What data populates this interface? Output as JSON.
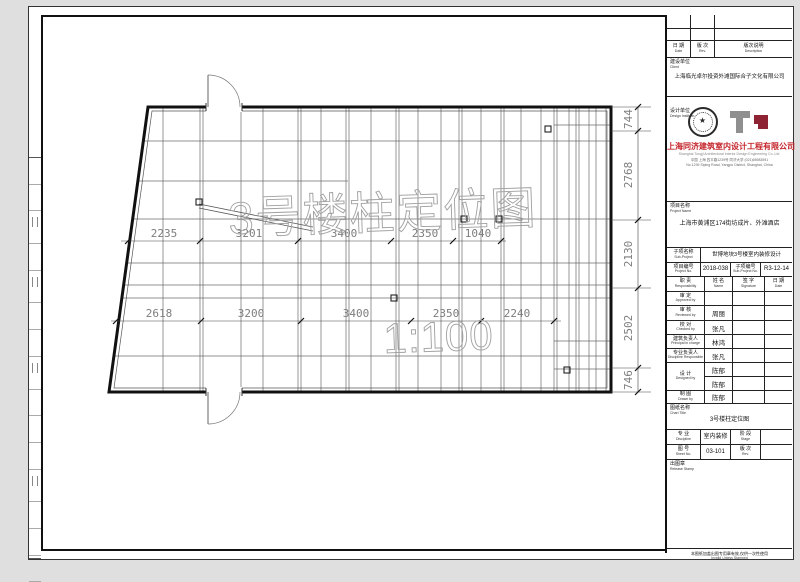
{
  "document": {
    "watermark_title": "3号楼柱定位图",
    "watermark_scale": "1:100"
  },
  "plan": {
    "dims_upper": [
      "2235",
      "3201",
      "3400",
      "2350",
      "1040"
    ],
    "dims_lower": [
      "2618",
      "3200",
      "3400",
      "2350",
      "2240"
    ],
    "dims_right": [
      "744",
      "2768",
      "2130",
      "2502",
      "746"
    ]
  },
  "titleblock": {
    "rev_table": {
      "date_cn": "日 期",
      "date_en": "Date",
      "rev_cn": "版 次",
      "rev_en": "Rev.",
      "desc_cn": "版次说明",
      "desc_en": "Description"
    },
    "client": {
      "label_cn": "建设单位",
      "label_en": "Client",
      "name": "上海临光卓尔投资外滩国际合子文化有限公司"
    },
    "institute": {
      "label_cn": "设计单位",
      "label_en": "Design Institute",
      "name_cn": "上海同济建筑室内设计工程有限公司",
      "name_en": "Shanghai Tongji Architectural Interior Design Engineering Co.,Ltd.",
      "address_cn": "中国 上海 四平路1239号 同济大学 (021)65983591",
      "address_en": "No.1239 Siping Road, Yangpu District, Shanghai, China"
    },
    "project": {
      "label_cn": "项目名称",
      "label_en": "Project Name",
      "name": "上海市黄浦区174街坊成片、外滩酒店"
    },
    "subproject": {
      "label_cn": "子项名称",
      "label_en": "Sub-Project",
      "name": "世博地块3号楼室内装修设计"
    },
    "numbers": {
      "proj_label_cn": "项目编号",
      "proj_label_en": "Project No.",
      "proj_no": "2018-038",
      "sub_label_cn": "子项编号",
      "sub_label_en": "Sub-Project No.",
      "sub_no": "R3-12-14"
    },
    "resp_header": {
      "resp_cn": "职    责",
      "resp_en": "Responsibility",
      "name_cn": "姓    名",
      "name_en": "Name",
      "sign_cn": "签    字",
      "sign_en": "Signature",
      "date_cn": "日    期",
      "date_en": "Date"
    },
    "people": [
      {
        "role_cn": "审    定",
        "role_en": "Approved by",
        "name": ""
      },
      {
        "role_cn": "审    核",
        "role_en": "Reviewed by",
        "name": "周丽"
      },
      {
        "role_cn": "校    对",
        "role_en": "Checked by",
        "name": "张凡"
      },
      {
        "role_cn": "建筑负责人",
        "role_en": "Principal in charge",
        "name": "林鸿"
      },
      {
        "role_cn": "专业负责人",
        "role_en": "Discipline Responsible",
        "name": "张凡"
      }
    ],
    "designed": {
      "role_cn": "设    计",
      "role_en": "Designed by",
      "name1": "陈郁",
      "name2": "陈郁"
    },
    "drawn": {
      "role_cn": "制    图",
      "role_en": "Drawn by",
      "name": "陈郁"
    },
    "sheet_title": {
      "label_cn": "图纸名称",
      "label_en": "Chart Title",
      "value": "3号楼柱定位图"
    },
    "discipline_row": {
      "label_cn": "专    业",
      "label_en": "Discipline",
      "value": "室内装修",
      "stage_cn": "阶    段",
      "stage_en": "Stage",
      "stage_value": ""
    },
    "sheetno_row": {
      "label_cn": "图    号",
      "label_en": "Sheet No.",
      "value": "03-101",
      "rev_cn": "版    次",
      "rev_en": "Rev.",
      "rev_value": ""
    },
    "stamp": {
      "label_cn": "出图章",
      "label_en": "Release Stamp"
    },
    "note": {
      "line1": "本图纸加盖出图专用章有效,仅供一次性使用",
      "line2": "Invalid Unless Stamped"
    }
  }
}
